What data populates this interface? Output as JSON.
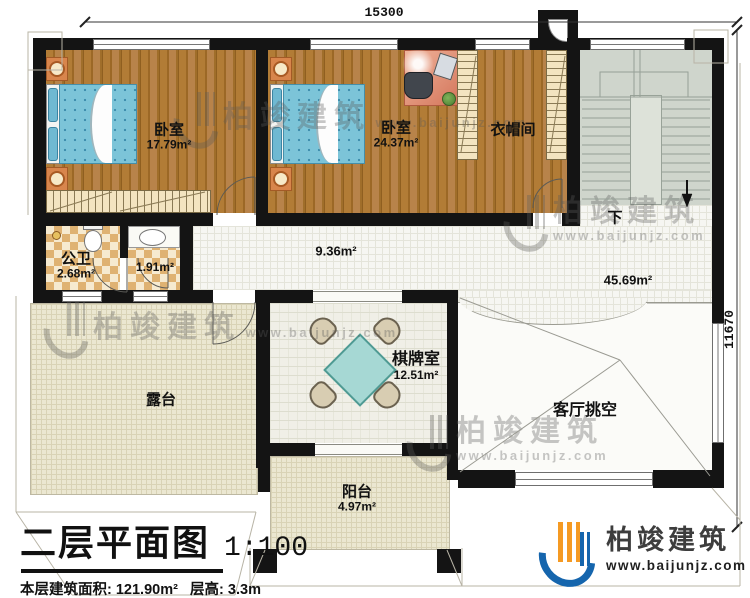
{
  "dimensions": {
    "top": "15300",
    "right": "11670"
  },
  "rooms": {
    "bedroom1": {
      "label": "卧室",
      "area": "17.79m²"
    },
    "bedroom2": {
      "label": "卧室",
      "area": "24.37m²"
    },
    "cloakroom": {
      "label": "衣帽间"
    },
    "public_bath": {
      "label": "公卫",
      "area": "2.68m²"
    },
    "washroom": {
      "area": "1.91m²"
    },
    "corridor": {
      "area": "9.36m²"
    },
    "hall": {
      "area": "45.69m²"
    },
    "chess_room": {
      "label": "棋牌室",
      "area": "12.51m²"
    },
    "terrace": {
      "label": "露台"
    },
    "living_void": {
      "label": "客厅挑空"
    },
    "balcony": {
      "label": "阳台",
      "area": "4.97m²"
    },
    "stairs": {
      "direction_label": "下"
    }
  },
  "title_block": {
    "title": "二层平面图",
    "scale": "1:100",
    "floor_area_label": "本层建筑面积:",
    "floor_area_value": "121.90m²",
    "floor_height_label": "层高:",
    "floor_height_value": "3.3m"
  },
  "brand": {
    "name": "柏竣建筑",
    "website": "www.baijunjz.com"
  },
  "watermark": {
    "name": "柏竣建筑",
    "website": "www.baijunjz.com"
  },
  "colors": {
    "wall": "#141414",
    "wood": "#a9752f",
    "tile": "#f6f6f2",
    "checker": "#dfb272",
    "stairs": "#cfd5cc",
    "terrace": "#ebe7d1",
    "bed": "#7cc4d8",
    "table": "#a6d8d4",
    "accent_blue": "#1565ad",
    "accent_orange": "#f59a23"
  }
}
